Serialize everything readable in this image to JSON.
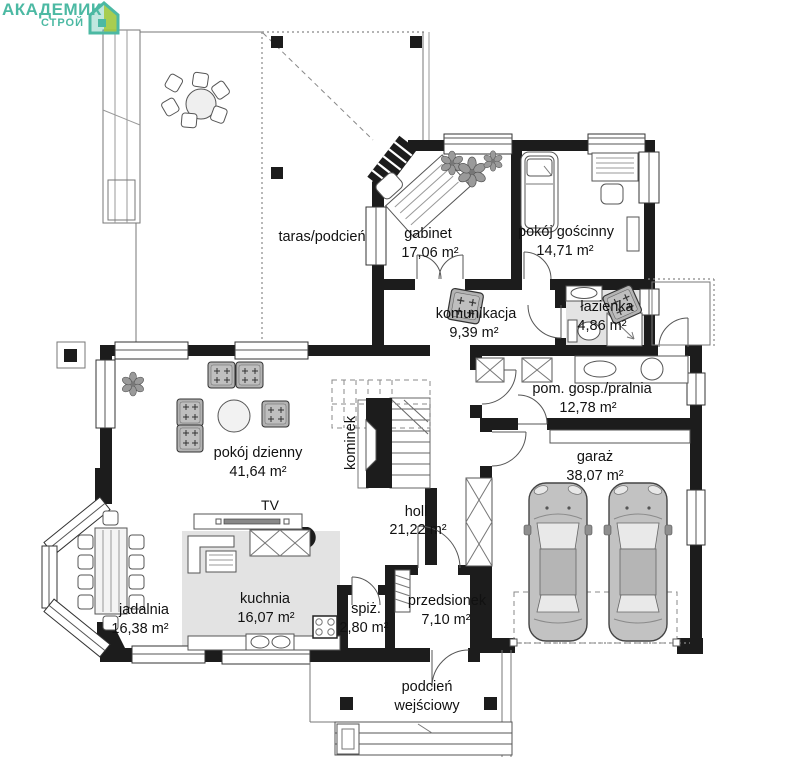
{
  "logo": {
    "line1": "АКАДЕМИК",
    "line2": "СТРОЙ",
    "color": "#4cb9a3",
    "accent": "#9fc83e"
  },
  "rooms": {
    "taras": {
      "name": "taras/podcień"
    },
    "gabinet": {
      "name": "gabinet",
      "area": "17,06 m²"
    },
    "goscinny": {
      "name": "pokój gościnny",
      "area": "14,71 m²"
    },
    "komunikacja": {
      "name": "komunikacja",
      "area": "9,39 m²"
    },
    "lazienka": {
      "name": "łazienka",
      "area": "4,86 m²"
    },
    "pralnia": {
      "name": "pom. gosp./pralnia",
      "area": "12,78 m²"
    },
    "dzienny": {
      "name": "pokój dzienny",
      "area": "41,64 m²"
    },
    "kominek": {
      "name": "kominek"
    },
    "tv": {
      "name": "TV"
    },
    "holl": {
      "name": "holl",
      "area": "21,22 m²"
    },
    "garaz": {
      "name": "garaż",
      "area": "38,07 m²"
    },
    "jadalnia": {
      "name": "jadalnia",
      "area": "16,38 m²"
    },
    "kuchnia": {
      "name": "kuchnia",
      "area": "16,07 m²"
    },
    "spiz": {
      "name": "spiż.",
      "area": "2,80 m²"
    },
    "przedsionek": {
      "name": "przedsionek",
      "area": "7,10 m²"
    },
    "podcien": {
      "line1": "podcień",
      "line2": "wejściowy"
    }
  },
  "colors": {
    "wall": "#1c1c1c",
    "floor_tile": "#e3e3e3"
  }
}
